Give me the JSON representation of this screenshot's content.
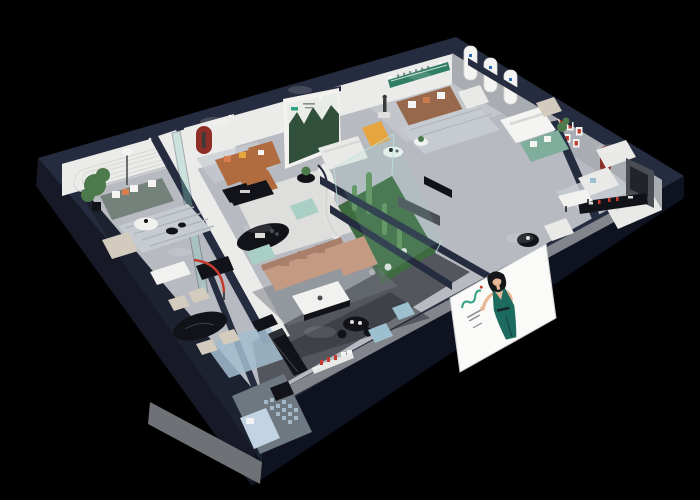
{
  "meta": {
    "type": "3d-isometric-cutaway-showroom-render",
    "view": "dollhouse corner cutaway, dark navy walls, spot-lit rooms",
    "canvas": {
      "width": 700,
      "height": 500
    }
  },
  "palette": {
    "bg": "#000000",
    "wallTop": "#262c3f",
    "wallFaceSW": "#171a26",
    "wallFaceSW2": "#1d2230",
    "wallFaceSE": "#0f1320",
    "slabGray": "#6e7176",
    "frontFace": "#82858c",
    "floor": "#b7bac0",
    "floorLight": "#cdd0d3",
    "floorDark": "#53565d",
    "floorDarker": "#2f3137",
    "sunkenFloor": "#6e7881",
    "innerWallWhite": "#ebebe9",
    "innerWallGray": "#a9acb0",
    "platform": "#dfdfdd",
    "grooveLine": "#d7d7d5",
    "posterBg": "#f3f2ee",
    "posterSky": "#e9ece7",
    "forestDark": "#31503c",
    "brandGreen": "#2fa083",
    "shelfGreen": "#2f7d63",
    "logoBlue": "#2b6cb0",
    "redAccent": "#8e2f27",
    "redBright": "#c23b2e",
    "sofaCaramel": "#b06c3f",
    "sofaBrown": "#97684c",
    "sofaTan": "#c49a83",
    "sofaTanDark": "#a87f6b",
    "sofaSage": "#75827b",
    "sofaWhite": "#e9eae8",
    "sofaGreenGray": "#7fae9c",
    "armBeige": "#d3cbbd",
    "benchMint": "#a9cfc4",
    "chaiseYellow": "#e6a53f",
    "pillowWhite": "#f4f4f2",
    "pillowOrange": "#d97f4e",
    "tableBlack": "#121318",
    "tableDarkTop": "#2c2e35",
    "tableWhite": "#f1f1ef",
    "rugLight": "#c6cbd1",
    "rugStripe": "#aeb3b9",
    "rugBlue": "#a3bdd0",
    "rugDark": "#70747b",
    "plantGreen": "#4d7a4c",
    "terrariumFloor": "#3f6b41",
    "cactus": "#5f9159",
    "glassTint": "#8fd2c3",
    "glassEdge": "#bfe4da",
    "glassFrame": "#2b3147",
    "poufBlue": "#9cc0cf",
    "bedBlue": "#c2d3e3",
    "mosaic": "#a9c0d2",
    "skin": "#e8b795",
    "hair": "#14161a",
    "dressTeal": "#1d6a5e",
    "billboardWhite": "#fafaf8",
    "billboardEdge": "#caccce",
    "metalGray": "#4a4d53",
    "textGray": "#8a8d92",
    "statue": "#3a3a38",
    "lampStem": "#44464b",
    "glow": "#ffffff"
  },
  "scene": {
    "building": {
      "style": "corner cutaway showroom",
      "walls": "dark navy cut edges",
      "floors": "light gray"
    },
    "rooms": [
      {
        "id": "lounge-top-left",
        "items": [
          "caramel-leather-sofa",
          "red-arched-niche",
          "figurine",
          "floor-lamp",
          "black-coffee-table",
          "glass-partition"
        ]
      },
      {
        "id": "lounge-left",
        "items": [
          "sage-green-sofa",
          "potted-plant",
          "round-white-table",
          "striped-rug",
          "beige-armchair"
        ]
      },
      {
        "id": "gallery-center",
        "items": [
          "forest-poster-wall",
          "leather-sofa",
          "beige-sofa",
          "black-oval-display-table",
          "mint-benches",
          "curved-partition"
        ]
      },
      {
        "id": "living-center",
        "items": [
          "tan-sectional-sofa",
          "white-coffee-table",
          "dark-rug",
          "black-console"
        ]
      },
      {
        "id": "atrium-terrarium",
        "items": [
          "glass-walls",
          "cacti",
          "white-flower-clusters"
        ]
      },
      {
        "id": "lounge-top-center",
        "items": [
          "brown-leather-sofa",
          "statue",
          "yellow-chaise",
          "round-marble-tables",
          "striped-rug",
          "wall-lettering",
          "green-display-shelf",
          "white-armchair"
        ]
      },
      {
        "id": "bedroom-top-right",
        "items": [
          "white-bed",
          "green-gray-sofa",
          "arched-display-panels",
          "potted-plant"
        ]
      },
      {
        "id": "lounge-right",
        "items": [
          "white-sofas",
          "white-chaise",
          "media-console-red-accents",
          "tv-panel",
          "white-side-table",
          "round-black-table",
          "white-ottoman",
          "red-arched-niche",
          "red-framed-pictures"
        ]
      },
      {
        "id": "dining-bottom-left",
        "items": [
          "black-oval-dining-table",
          "cream-chairs",
          "red-arc-floor-lamp",
          "blue-rug",
          "white-console",
          "dark-cabinet"
        ]
      },
      {
        "id": "kitchen-bottom-center",
        "items": [
          "black-island",
          "black-bench",
          "round-black-table",
          "blue-poufs",
          "wall-shelf-red-accents"
        ]
      },
      {
        "id": "sunken-corner-room",
        "items": [
          "light-blue-bed",
          "mosaic-tiles",
          "black-cube-table"
        ]
      }
    ],
    "facade_billboard": {
      "subject": "illustrated woman, long black hair, teal green dress, one hand raised and one on hip",
      "branding": "small green logo mark with red dot and fine gray text lines"
    }
  }
}
